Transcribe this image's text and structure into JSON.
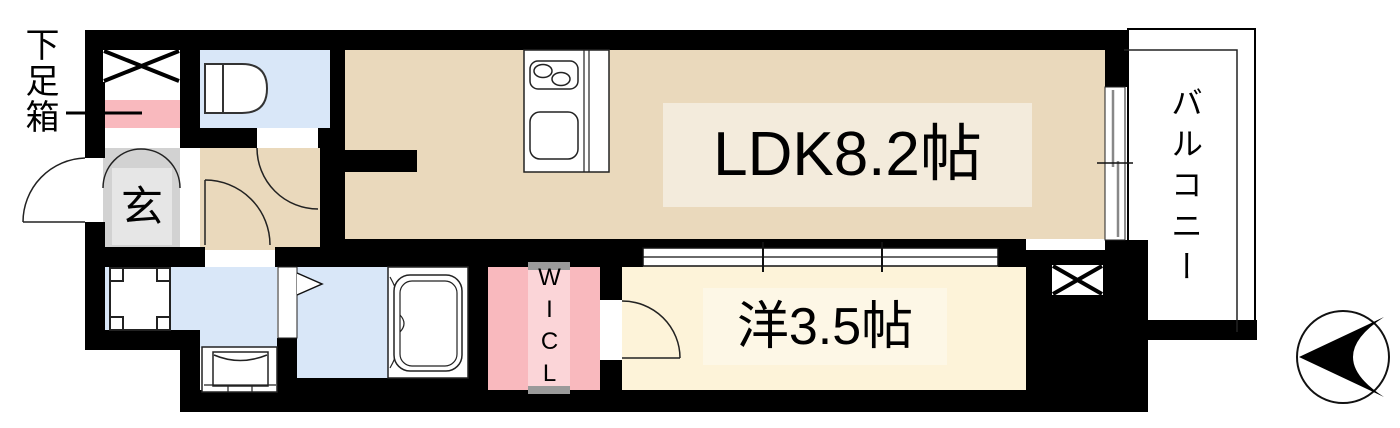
{
  "labels": {
    "shoe_box": "下足箱",
    "entrance": "玄",
    "ldk": "LDK8.2帖",
    "western_room": "洋3.5帖",
    "walk_in_closet": "WICL",
    "balcony": "バルコニー"
  },
  "colors": {
    "wall": "#000000",
    "ldk_floor": "#ead9bc",
    "western_room_floor": "#fdf3d9",
    "wet_area_floor": "#d9e7f8",
    "closet_pink": "#f9b9be",
    "closet_inner_pink": "#fbd5d8",
    "genkan_gray": "#d2d2d2",
    "genkan_inner_gray": "#e6e6e6",
    "ldk_label_bg": "#f3ebdc",
    "western_label_bg": "#fdf7e6",
    "door_cap_gray": "#9a9a9a"
  },
  "icons": {
    "compass": "north-arrow",
    "toilet": "toilet-fixture",
    "bathtub": "bathtub-fixture",
    "kitchen": "kitchen-counter-with-stove-and-sink",
    "washing_machine": "washing-machine-pan",
    "washbasin": "vanity-washbasin",
    "shaft": "x-cross-shaft"
  }
}
